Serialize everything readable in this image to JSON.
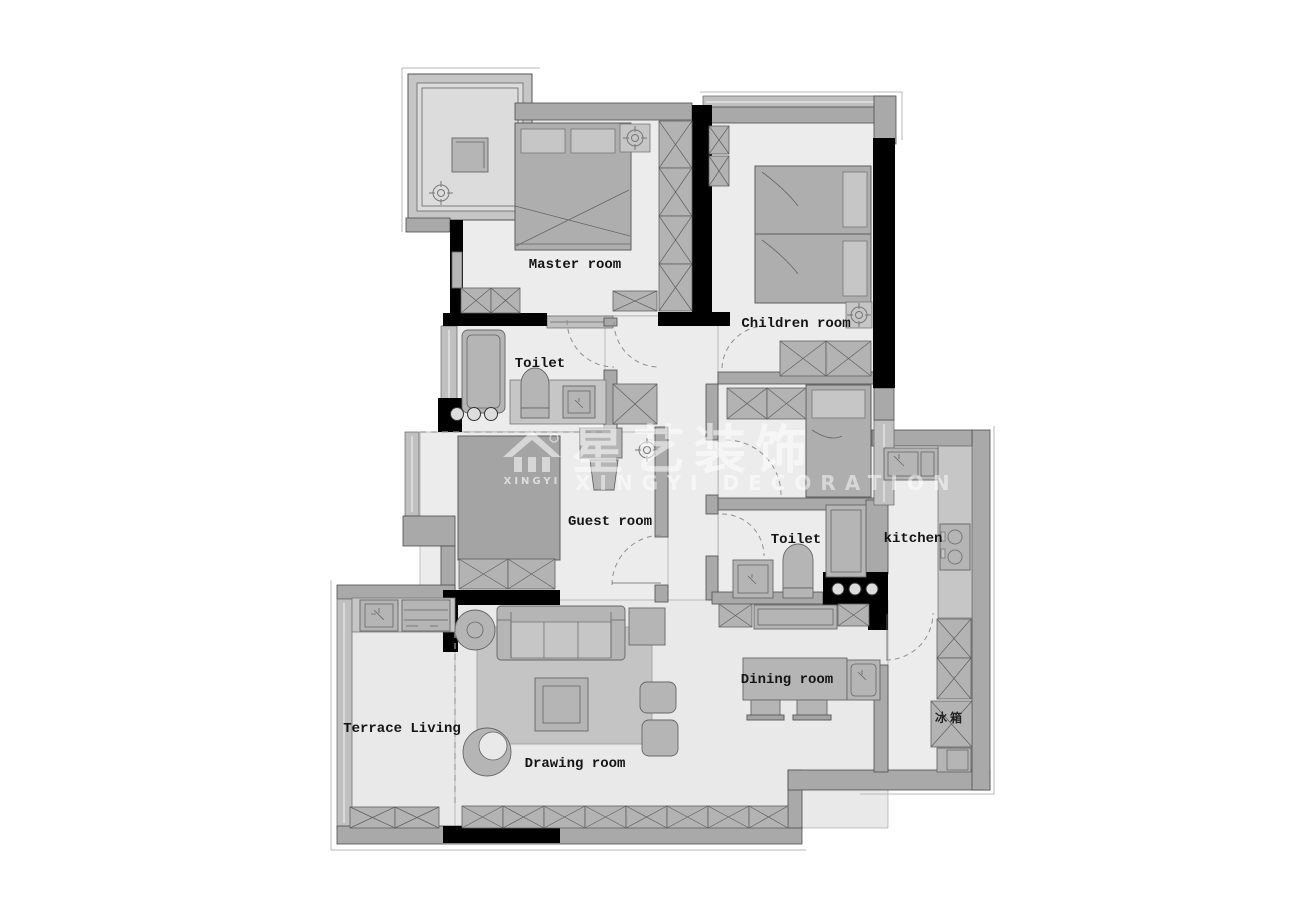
{
  "watermark": {
    "logo_text": "XINGYI",
    "brand_cn": "星艺装饰",
    "brand_en": "XINGYI DECORATION"
  },
  "rooms": {
    "master": {
      "label": "Master room"
    },
    "children": {
      "label": "Children room"
    },
    "toilet_upper": {
      "label": "Toilet"
    },
    "toilet_lower": {
      "label": "Toilet"
    },
    "guest": {
      "label": "Guest room"
    },
    "kitchen": {
      "label": "kitchen"
    },
    "terrace": {
      "label": "Terrace Living"
    },
    "drawing": {
      "label": "Drawing room"
    },
    "dining": {
      "label": "Dining room"
    }
  },
  "appliances": {
    "fridge": {
      "label": "冰箱"
    }
  },
  "colors": {
    "wall_gray": "#a9a9a9",
    "structure_black": "#000000",
    "floor": "#ececec",
    "furniture": "#b5b5b5",
    "watermark_white": "rgba(255,255,255,0.55)"
  }
}
